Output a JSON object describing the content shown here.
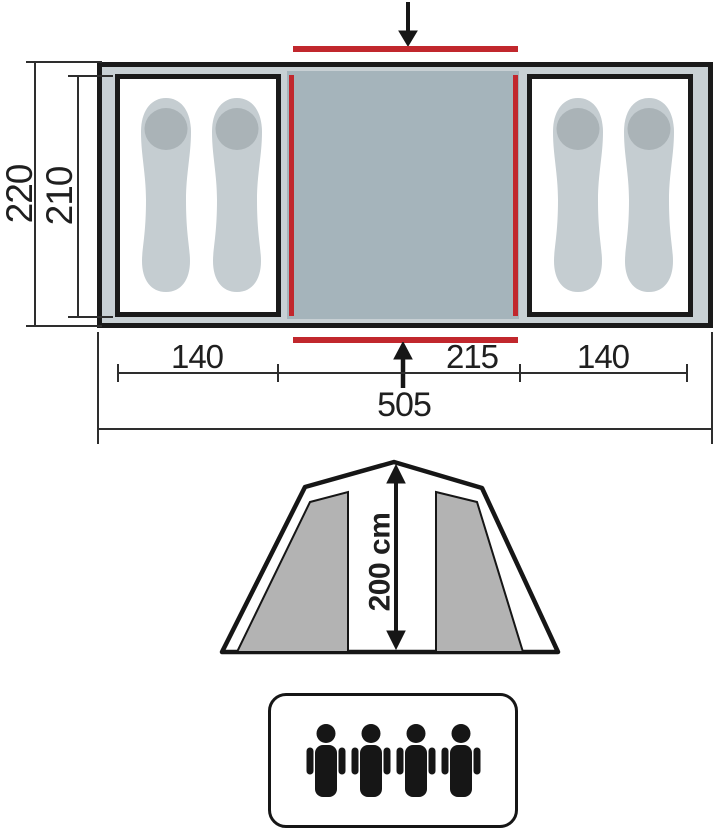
{
  "floor_plan": {
    "outer_height": "220",
    "inner_height": "210",
    "left_width": "140",
    "center_width": "215",
    "right_width": "140",
    "total_width": "505"
  },
  "elevation": {
    "peak_height": "200 cm"
  },
  "capacity": {
    "count": 4
  },
  "colors": {
    "accent_red": "#c1272d",
    "tent_fill": "#c8d0d4",
    "center_fill": "#a5b4bb",
    "pad_fill": "#c5cdd1",
    "pillow_fill": "#aab3b7",
    "panel_gray": "#b3b3b3",
    "line_black": "#1a1a1a"
  }
}
